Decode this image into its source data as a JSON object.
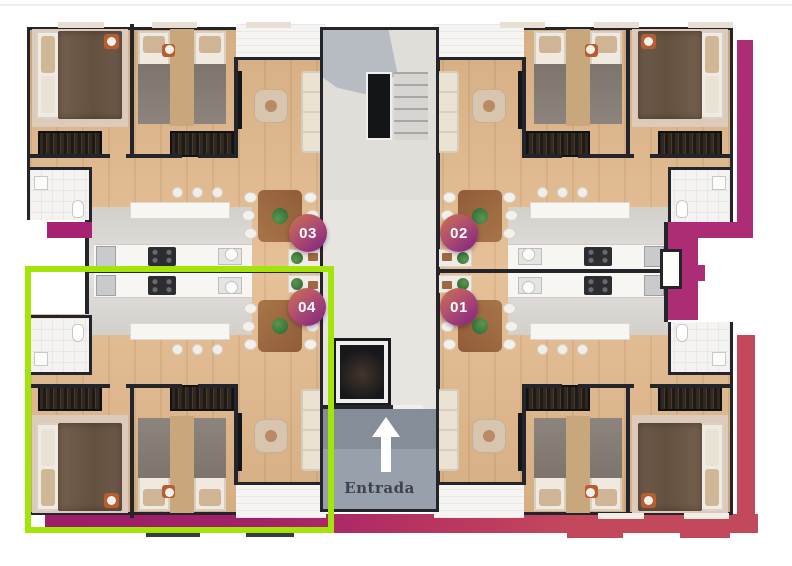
{
  "floorplan": {
    "entrance": {
      "label": "Entrada"
    },
    "units": [
      {
        "number": "03",
        "position": "top-left",
        "highlighted": false
      },
      {
        "number": "02",
        "position": "top-right",
        "highlighted": false
      },
      {
        "number": "04",
        "position": "bottom-left",
        "highlighted": true
      },
      {
        "number": "01",
        "position": "bottom-right",
        "highlighted": false
      }
    ],
    "colors": {
      "highlight_outline": "#a3e40b",
      "border_magenta": "#ac2d74",
      "border_red": "#c3485c",
      "border_deep_magenta": "#9b1e66",
      "badge_gradient_start": "#ca7350",
      "badge_gradient_end": "#8b2d7e",
      "badge_text": "#ffffff",
      "entrance_text": "#3d434d"
    }
  }
}
